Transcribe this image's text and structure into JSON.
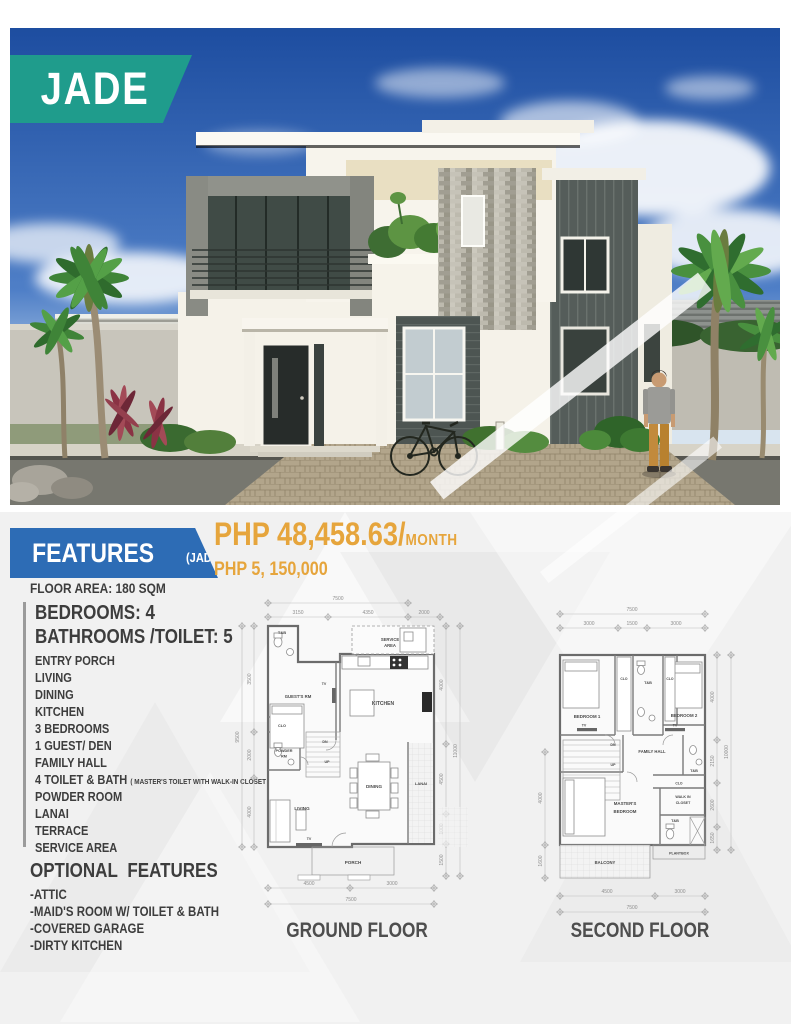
{
  "model": {
    "name": "JADE"
  },
  "pricing": {
    "monthly": "PHP 48,458.63/",
    "monthly_unit": "MONTH",
    "total": "PHP 5, 150,000"
  },
  "features": {
    "title": "FEATURES",
    "title_tag": "(JADE)",
    "floor_area": "FLOOR AREA: 180 SQM",
    "bedrooms": "BEDROOMS: 4",
    "bathrooms": "BATHROOMS /TOILET: 5",
    "items": [
      "ENTRY PORCH",
      "LIVING",
      "DINING",
      "KITCHEN",
      "3 BEDROOMS",
      "1 GUEST/ DEN",
      "FAMILY HALL"
    ],
    "toilet_bath": "4 TOILET & BATH",
    "toilet_bath_note": "( MASTER'S TOILET WITH WALK-IN CLOSET )",
    "items2": [
      "POWDER ROOM",
      "LANAI",
      "TERRACE",
      "SERVICE AREA"
    ],
    "optional_title": "OPTIONAL FEATURES",
    "optional_items": [
      "-ATTIC",
      "-MAID'S ROOM W/ TOILET & BATH",
      "-COVERED GARAGE",
      "-DIRTY KITCHEN"
    ]
  },
  "plans": {
    "ground": {
      "title": "GROUND FLOOR",
      "rooms": {
        "tb": "T&B",
        "service1": "SERVICE",
        "service2": "AREA",
        "guest": "GUEST'S RM",
        "tv1": "TV",
        "kitchen": "KITCHEN",
        "clo": "CLO",
        "powder1": "POWDER",
        "powder2": "RM",
        "dn": "DN",
        "up": "UP",
        "dining": "DINING",
        "lanai": "LANAI",
        "living": "LIVING",
        "tv2": "TV",
        "porch": "PORCH"
      },
      "dims": {
        "top_overall": "7500",
        "top1": "3150",
        "top2": "4350",
        "top3": "2000",
        "left1": "3500",
        "left2": "2000",
        "left3": "4000",
        "left_overall": "9500",
        "right1": "4000",
        "right2": "4500",
        "right3": "1000",
        "right4": "1500",
        "right_overall": "11000",
        "bottom1": "4500",
        "bottom2": "3000",
        "bottom_overall": "7500"
      }
    },
    "second": {
      "title": "SECOND FLOOR",
      "rooms": {
        "bedroom1": "BEDROOM 1",
        "clo1": "CLO",
        "tb1": "T&B",
        "clo2": "CLO",
        "bedroom2": "BEDROOM 2",
        "tv1": "TV",
        "tv2": "TV",
        "family": "FAMILY HALL",
        "dn": "DN",
        "up": "UP",
        "tb2": "T&B",
        "clo3": "CLO",
        "walkin1": "WALK IN",
        "walkin2": "CLOSET",
        "master1": "MASTER'S",
        "master2": "BEDROOM",
        "tb3": "T&B",
        "plantbox": "PLANTBOX",
        "balcony": "BALCONY"
      },
      "dims": {
        "top_overall": "7500",
        "top1": "3000",
        "top2": "1500",
        "top3": "3000",
        "left1": "4000",
        "left2": "1600",
        "right1": "4000",
        "right2": "2150",
        "right3": "2600",
        "right4": "1650",
        "right_overall": "10000",
        "bottom1": "4500",
        "bottom2": "3000",
        "bottom_overall": "7500"
      }
    }
  },
  "colors": {
    "teal": "#1f9c8c",
    "blue": "#2d6cb5",
    "gold": "#e6a53c"
  }
}
